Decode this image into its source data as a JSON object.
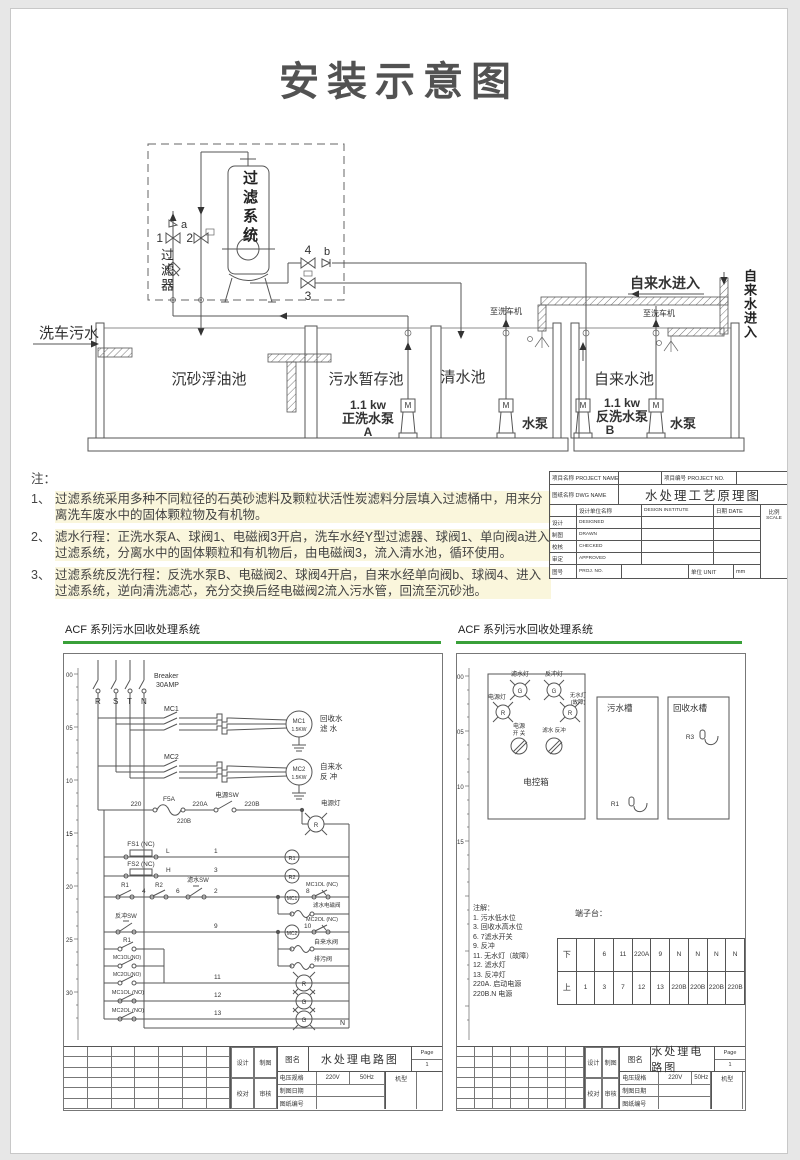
{
  "page": {
    "title": "安装示意图"
  },
  "piping": {
    "filter_system": "过滤系统",
    "filter": "过滤器",
    "v1": "1",
    "v2": "2",
    "v3": "3",
    "v4": "4",
    "a": "a",
    "b": "b",
    "carwash_sewage": "洗车污水",
    "tank_sand": "沉砂浮油池",
    "tank_sewage": "污水暂存池",
    "tank_clean": "清水池",
    "tank_tap": "自来水池",
    "kw": "1.1 kw",
    "pump_forward": "正洗水泵",
    "pump_forward_id": "A",
    "pump_back": "反洗水泵",
    "pump_back_id": "B",
    "pump_label": "水泵",
    "motor": "M",
    "tap_in": "自来水进入",
    "tap_in_side": "自来水进入",
    "to_carwash": "至洗车机"
  },
  "notes": {
    "heading": "注：",
    "items": [
      {
        "num": "1、",
        "text": "过滤系统采用多种不同粒径的石英砂滤料及颗粒状活性炭滤料分层填入过滤桶中，用来分离洗车废水中的固体颗粒物及有机物。"
      },
      {
        "num": "2、",
        "text": "滤水行程：正洗水泵A、球阀1、电磁阀3开启，洗车水经Y型过滤器、球阀1、单向阀a进入过滤系统，分离水中的固体颗粒和有机物后，由电磁阀3，流入清水池，循环使用。"
      },
      {
        "num": "3、",
        "text": "过滤系统反洗行程：反洗水泵B、电磁阀2、球阀4开启，自来水经单向阀b、球阀4、进入过滤系统，逆向清洗滤芯，充分交换后经电磁阀2流入污水管，回流至沉砂池。"
      }
    ]
  },
  "main_block": {
    "project_label": "项目名称  PROJECT NAME",
    "project_no_label": "项目编号 PROJECT NO.",
    "dwg_label": "图纸名称  DWG NAME",
    "dwg_title": "水处理工艺原理图",
    "org_label": "设计单位名称",
    "org_en": "DESIGN INSTITUTE",
    "date_label": "日期  DATE",
    "scale_label1": "比例",
    "scale_label2": "SCALE",
    "rows": [
      {
        "cn": "设计",
        "en": "DESIGNED"
      },
      {
        "cn": "制图",
        "en": "DRAWN"
      },
      {
        "cn": "校核",
        "en": "CHECKED"
      },
      {
        "cn": "审定",
        "en": "APPROVED"
      }
    ],
    "no_cn": "图号",
    "no_en": "PROJ. NO.",
    "unit_label": "单位  UNIT",
    "unit_value": "mm"
  },
  "acf_header": "ACF 系列污水回收处理系统",
  "left_circuit": {
    "ruler": [
      "00",
      "05",
      "10",
      "15",
      "20",
      "25",
      "30"
    ],
    "breaker1": "Breaker",
    "breaker2": "30AMP",
    "phases": [
      "R",
      "S",
      "T",
      "N"
    ],
    "mc1": "MC1",
    "mc2": "MC2",
    "motor1_name": "MC1",
    "motor1_kw": "1.5KW",
    "motor1_use1": "回收水",
    "motor1_use2": "滤 水",
    "motor2_name": "MC2",
    "motor2_kw": "1.5KW",
    "motor2_use1": "自来水",
    "motor2_use2": "反 冲",
    "w220": "220",
    "fuse": "F5A",
    "w220a": "220A",
    "sw_power": "电源SW",
    "w220b": "220B",
    "w220b2": "220B",
    "lamp_power": "电源灯",
    "lamp_power_letter": "R",
    "fs1": "FS1 (NC)",
    "fs2": "FS2 (NC)",
    "wL": "L",
    "wH": "H",
    "n1": "1",
    "n3": "3",
    "r1": "R1",
    "r2": "R2",
    "r1b": "R1",
    "n4": "4",
    "n6": "6",
    "sw_filter": "滤水SW",
    "n2": "2",
    "coil1": "MC1",
    "n8": "8",
    "mc1ol_nc": "MC1OL (NC)",
    "sol_filter": "滤水电磁阀",
    "sw_back": "反冲SW",
    "n9": "9",
    "coil2": "MC2",
    "n10": "10",
    "mc2ol_nc": "MC2OL (NC)",
    "sol_tap": "自来水阀",
    "sol_drain": "排污阀",
    "mc1ol_no": "MC1OL(NO)",
    "mc2ol_no": "MC2OL(NO)",
    "n11": "11",
    "lampR": "R",
    "mc1ol_no2": "MC1OL (NO)",
    "n12": "12",
    "mc2ol_no2": "MC2OL (NO)",
    "n13": "13",
    "lampG": "G",
    "nlabel": "N"
  },
  "right_panel": {
    "ruler": [
      "00",
      "05",
      "10",
      "15"
    ],
    "box": "电控箱",
    "lamp_filter": "滤水灯",
    "lamp_power": "电源灯",
    "lamp_back": "反冲灯",
    "lamp_nowater1": "无水灯",
    "lamp_nowater2": "(故障)",
    "lG": "G",
    "lR": "R",
    "sw1a": "电源",
    "sw1b": "开  关",
    "sw2": "滤水 反冲",
    "tank_sewage": "污水槽",
    "tank_recycle": "回收水槽",
    "r1": "R1",
    "r3": "R3",
    "notes_title": "注解：",
    "notes": [
      "1. 污水低水位",
      "3. 回收水高水位",
      "6. 7滤水开关",
      "9. 反冲",
      "11. 无水灯（故障）",
      "12. 滤水灯",
      "13. 反冲灯",
      "220A. 启动电源",
      "220B.N 电源"
    ],
    "terminal_title": "端子台：",
    "row_down": "下",
    "row_up": "上",
    "t0": [
      "",
      "6",
      "11",
      "220A",
      "9",
      "N",
      "N",
      "N",
      "N"
    ],
    "t1": [
      "1",
      "3",
      "7",
      "12",
      "13",
      "220B",
      "220B",
      "220B",
      "220B"
    ]
  },
  "dwg_block": {
    "design": "设计",
    "draft": "制图",
    "proof": "校对",
    "audit": "审核",
    "name_label": "图名",
    "title": "水处理电路图",
    "page_label": "Page",
    "page": "1",
    "volt_label": "电压规格",
    "volt": "220V",
    "hz": "50Hz",
    "model_label": "机型",
    "date_label": "制图日期",
    "no_label": "图纸编号"
  }
}
